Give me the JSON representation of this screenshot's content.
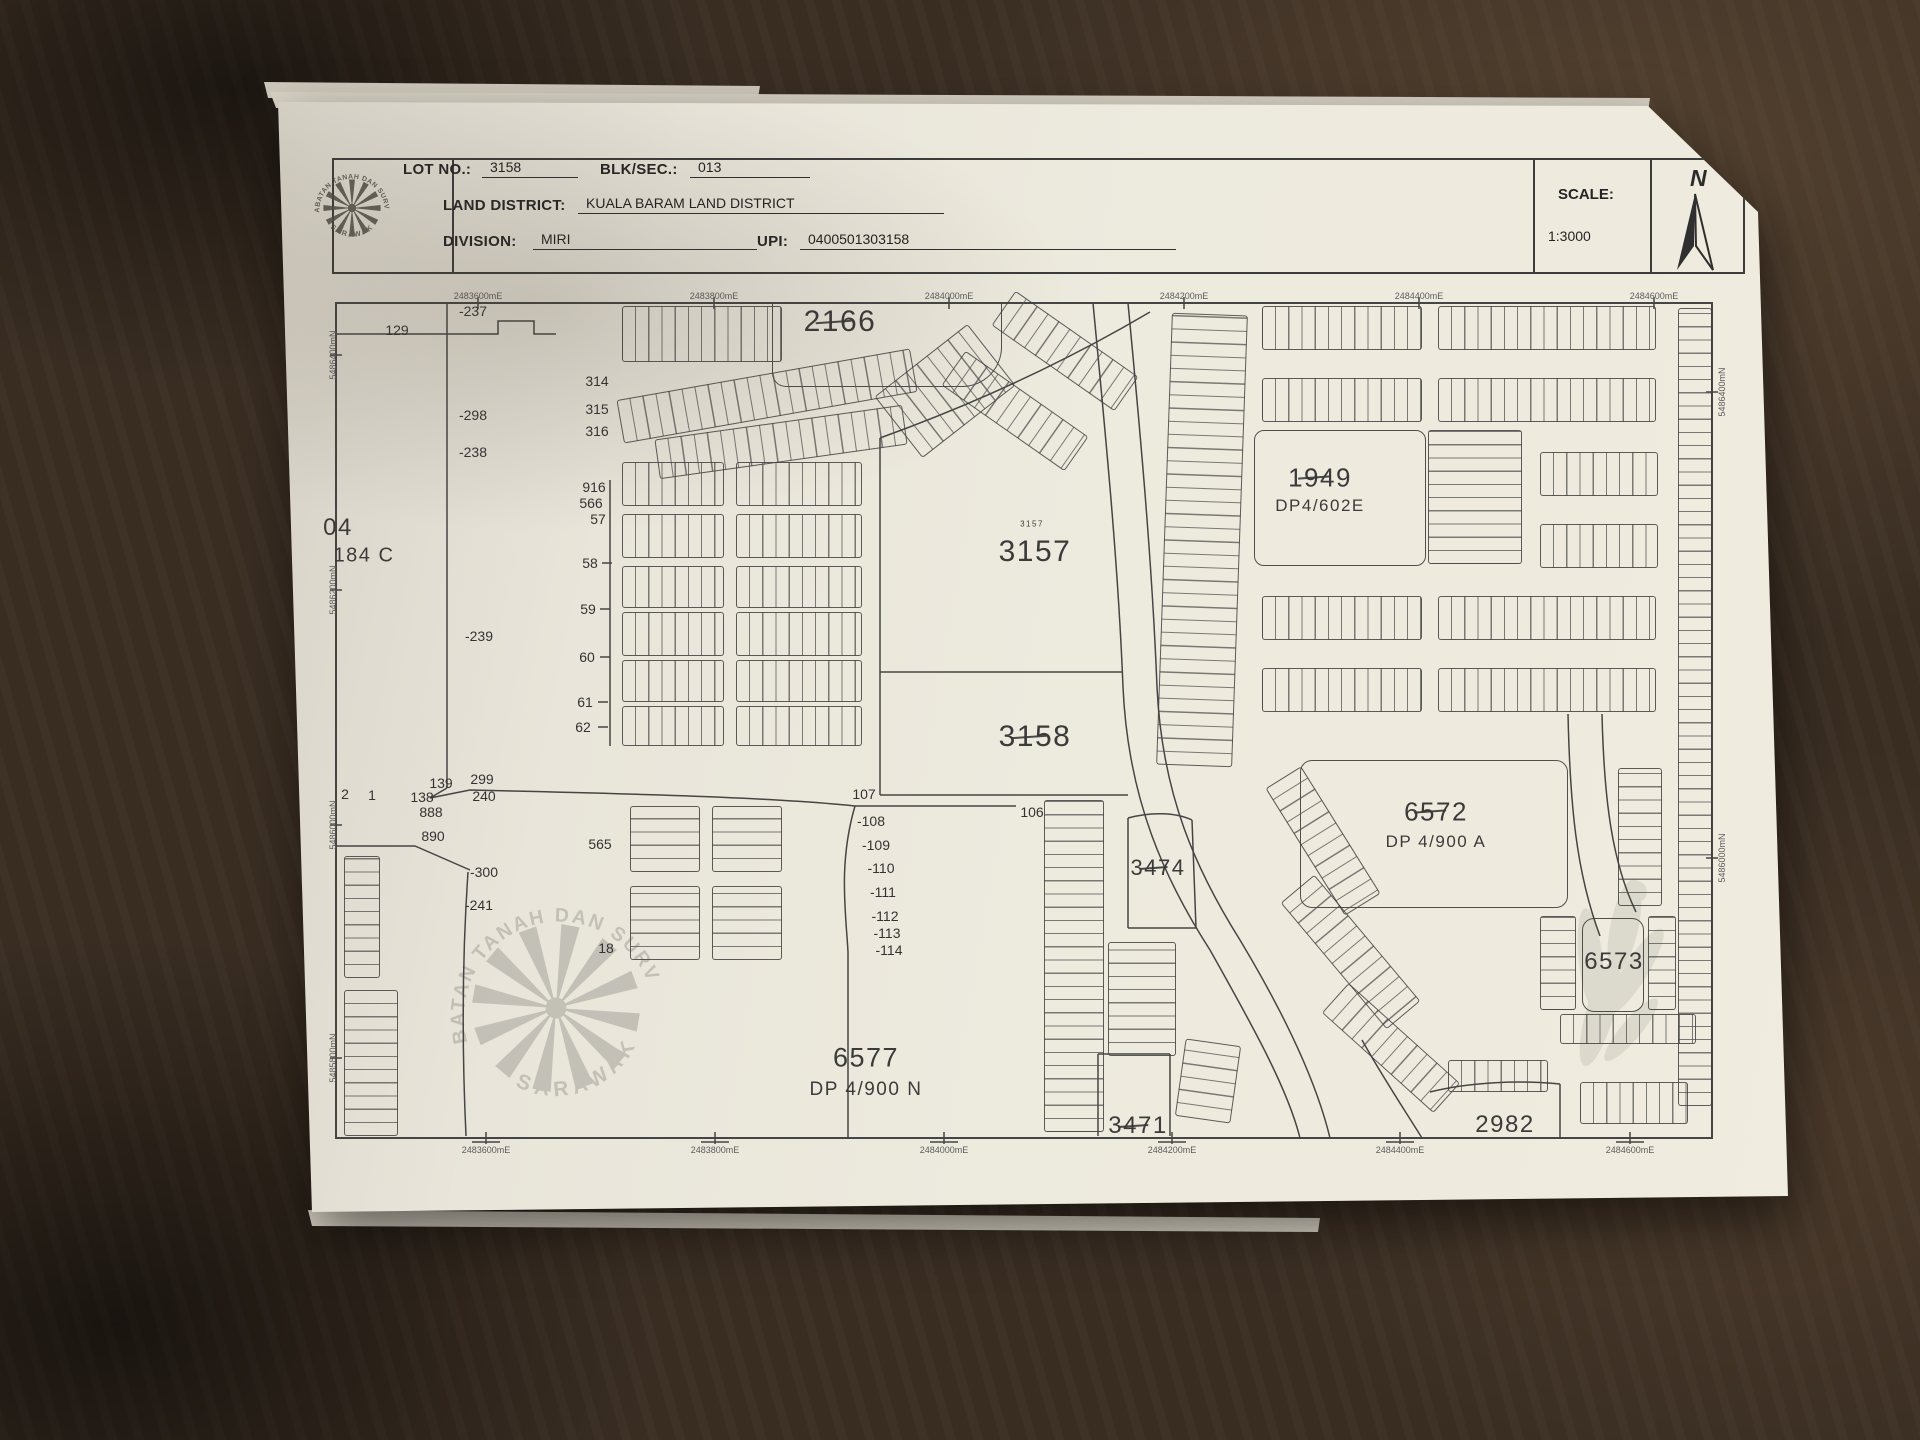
{
  "header": {
    "lot_no_label": "LOT NO.:",
    "lot_no_value": "3158",
    "blk_sec_label": "BLK/SEC.:",
    "blk_sec_value": "013",
    "land_district_label": "LAND DISTRICT:",
    "land_district_value": "KUALA BARAM LAND DISTRICT",
    "division_label": "DIVISION:",
    "division_value": "MIRI",
    "upi_label": "UPI:",
    "upi_value": "0400501303158",
    "scale_label": "SCALE:",
    "scale_value": "1:3000",
    "north_label": "N"
  },
  "stamp": {
    "arc_text": "JABATAN TANAH DAN SURVEI",
    "bottom_text": "SARAWAK"
  },
  "map": {
    "lot_labels": [
      {
        "t": "2166",
        "x": 840,
        "y": 322,
        "s": 30,
        "struck": true
      },
      {
        "t": "3157",
        "x": 1032,
        "y": 524,
        "s": 8,
        "struck": false
      },
      {
        "t": "3157",
        "x": 1035,
        "y": 552,
        "s": 30,
        "struck": false
      },
      {
        "t": "3158",
        "x": 1035,
        "y": 737,
        "s": 30,
        "struck": true
      },
      {
        "t": "1949",
        "x": 1320,
        "y": 478,
        "s": 26,
        "struck": true
      },
      {
        "t": "DP4/602E",
        "x": 1320,
        "y": 506,
        "s": 17,
        "struck": false
      },
      {
        "t": "6572",
        "x": 1436,
        "y": 812,
        "s": 26,
        "struck": true
      },
      {
        "t": "DP 4/900 A",
        "x": 1436,
        "y": 842,
        "s": 17,
        "struck": false
      },
      {
        "t": "6573",
        "x": 1614,
        "y": 962,
        "s": 24,
        "struck": false
      },
      {
        "t": "3474",
        "x": 1158,
        "y": 868,
        "s": 22,
        "struck": true
      },
      {
        "t": "3471",
        "x": 1138,
        "y": 1126,
        "s": 24,
        "struck": true
      },
      {
        "t": "2982",
        "x": 1505,
        "y": 1125,
        "s": 24,
        "struck": false
      },
      {
        "t": "6577",
        "x": 866,
        "y": 1058,
        "s": 27,
        "struck": false
      },
      {
        "t": "DP 4/900 N",
        "x": 866,
        "y": 1090,
        "s": 19,
        "struck": false
      },
      {
        "t": "04",
        "x": 338,
        "y": 528,
        "s": 24,
        "struck": false
      },
      {
        "t": "184 C",
        "x": 364,
        "y": 556,
        "s": 20,
        "struck": false
      }
    ],
    "tick_numbers": [
      {
        "t": "129",
        "x": 397,
        "y": 330
      },
      {
        "t": "-237",
        "x": 473,
        "y": 311
      },
      {
        "t": "-298",
        "x": 473,
        "y": 415
      },
      {
        "t": "-238",
        "x": 473,
        "y": 452
      },
      {
        "t": "314",
        "x": 597,
        "y": 381
      },
      {
        "t": "315",
        "x": 597,
        "y": 409
      },
      {
        "t": "316",
        "x": 597,
        "y": 431
      },
      {
        "t": "916",
        "x": 594,
        "y": 487
      },
      {
        "t": "566",
        "x": 591,
        "y": 503
      },
      {
        "t": "57",
        "x": 598,
        "y": 519
      },
      {
        "t": "58",
        "x": 590,
        "y": 563
      },
      {
        "t": "59",
        "x": 588,
        "y": 609
      },
      {
        "t": "60",
        "x": 587,
        "y": 657
      },
      {
        "t": "61",
        "x": 585,
        "y": 702
      },
      {
        "t": "62",
        "x": 583,
        "y": 727
      },
      {
        "t": "-239",
        "x": 479,
        "y": 636
      },
      {
        "t": "299",
        "x": 482,
        "y": 779
      },
      {
        "t": "240",
        "x": 484,
        "y": 796
      },
      {
        "t": "139",
        "x": 441,
        "y": 783
      },
      {
        "t": "138",
        "x": 422,
        "y": 797
      },
      {
        "t": "888",
        "x": 431,
        "y": 812
      },
      {
        "t": "890",
        "x": 433,
        "y": 836
      },
      {
        "t": "1",
        "x": 372,
        "y": 795
      },
      {
        "t": "2",
        "x": 345,
        "y": 794
      },
      {
        "t": "-300",
        "x": 484,
        "y": 872
      },
      {
        "t": "-241",
        "x": 479,
        "y": 905
      },
      {
        "t": "565",
        "x": 600,
        "y": 844
      },
      {
        "t": "18",
        "x": 606,
        "y": 948
      },
      {
        "t": "107",
        "x": 864,
        "y": 794
      },
      {
        "t": "-108",
        "x": 871,
        "y": 821
      },
      {
        "t": "-109",
        "x": 876,
        "y": 845
      },
      {
        "t": "-110",
        "x": 881,
        "y": 868
      },
      {
        "t": "-111",
        "x": 883,
        "y": 892
      },
      {
        "t": "-112",
        "x": 885,
        "y": 916
      },
      {
        "t": "-113",
        "x": 887,
        "y": 933
      },
      {
        "t": "-114",
        "x": 889,
        "y": 950
      },
      {
        "t": "106",
        "x": 1032,
        "y": 812
      }
    ],
    "coord_top": [
      {
        "t": "2483600mE",
        "x": 478
      },
      {
        "t": "2483800mE",
        "x": 714
      },
      {
        "t": "2484000mE",
        "x": 949
      },
      {
        "t": "2484200mE",
        "x": 1184
      },
      {
        "t": "2484400mE",
        "x": 1419
      },
      {
        "t": "2484600mE",
        "x": 1654
      }
    ],
    "coord_bottom": [
      {
        "t": "2483600mE",
        "x": 486
      },
      {
        "t": "2483800mE",
        "x": 715
      },
      {
        "t": "2484000mE",
        "x": 944
      },
      {
        "t": "2484200mE",
        "x": 1172
      },
      {
        "t": "2484400mE",
        "x": 1400
      },
      {
        "t": "2484600mE",
        "x": 1630
      }
    ],
    "coord_left": [
      {
        "t": "5486400mN",
        "y": 355
      },
      {
        "t": "5486200mN",
        "y": 590
      },
      {
        "t": "5486000mN",
        "y": 825
      },
      {
        "t": "5485800mN",
        "y": 1058
      }
    ],
    "coord_right": [
      {
        "t": "5486400mN",
        "y": 392
      },
      {
        "t": "5486000mN",
        "y": 858
      }
    ]
  }
}
